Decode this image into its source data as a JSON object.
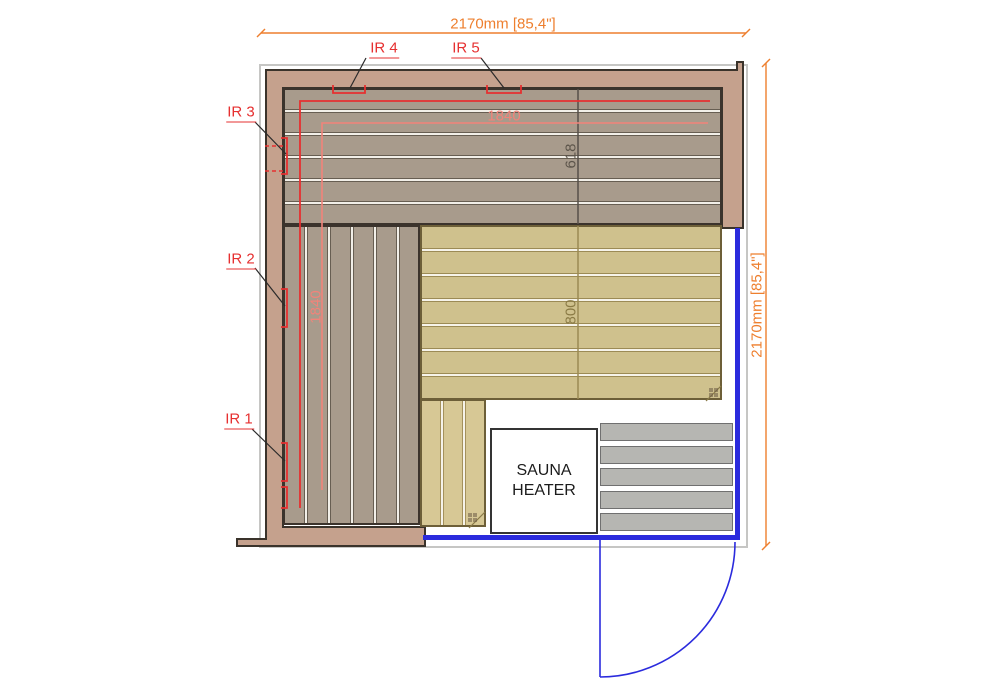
{
  "plan": {
    "title": "sauna-floor-plan",
    "dim_top": "2170mm [85,4\"]",
    "dim_right": "2170mm [85,4\"]",
    "measurements": {
      "ir_zone_width": "1840",
      "ir_zone_height": "1840",
      "top_bench_depth": "618",
      "side_bench_depth": "800"
    },
    "ir_labels": [
      {
        "label": "IR 1"
      },
      {
        "label": "IR 2"
      },
      {
        "label": "IR 3"
      },
      {
        "label": "IR 4"
      },
      {
        "label": "IR 5"
      }
    ],
    "heater_label": "SAUNA HEATER",
    "colors": {
      "wall": "#c5a18d",
      "bench_gray": "#a89b8c",
      "bench_tan": "#cfc18d",
      "bench_step_tan": "#d7c895",
      "floor_grate_gray": "#b6b6b2",
      "glass_blue": "#2b2bdd",
      "dimension_orange": "#ee7f2e",
      "annotation_red": "#e63030",
      "annotation_salmon": "#f2837a"
    }
  }
}
